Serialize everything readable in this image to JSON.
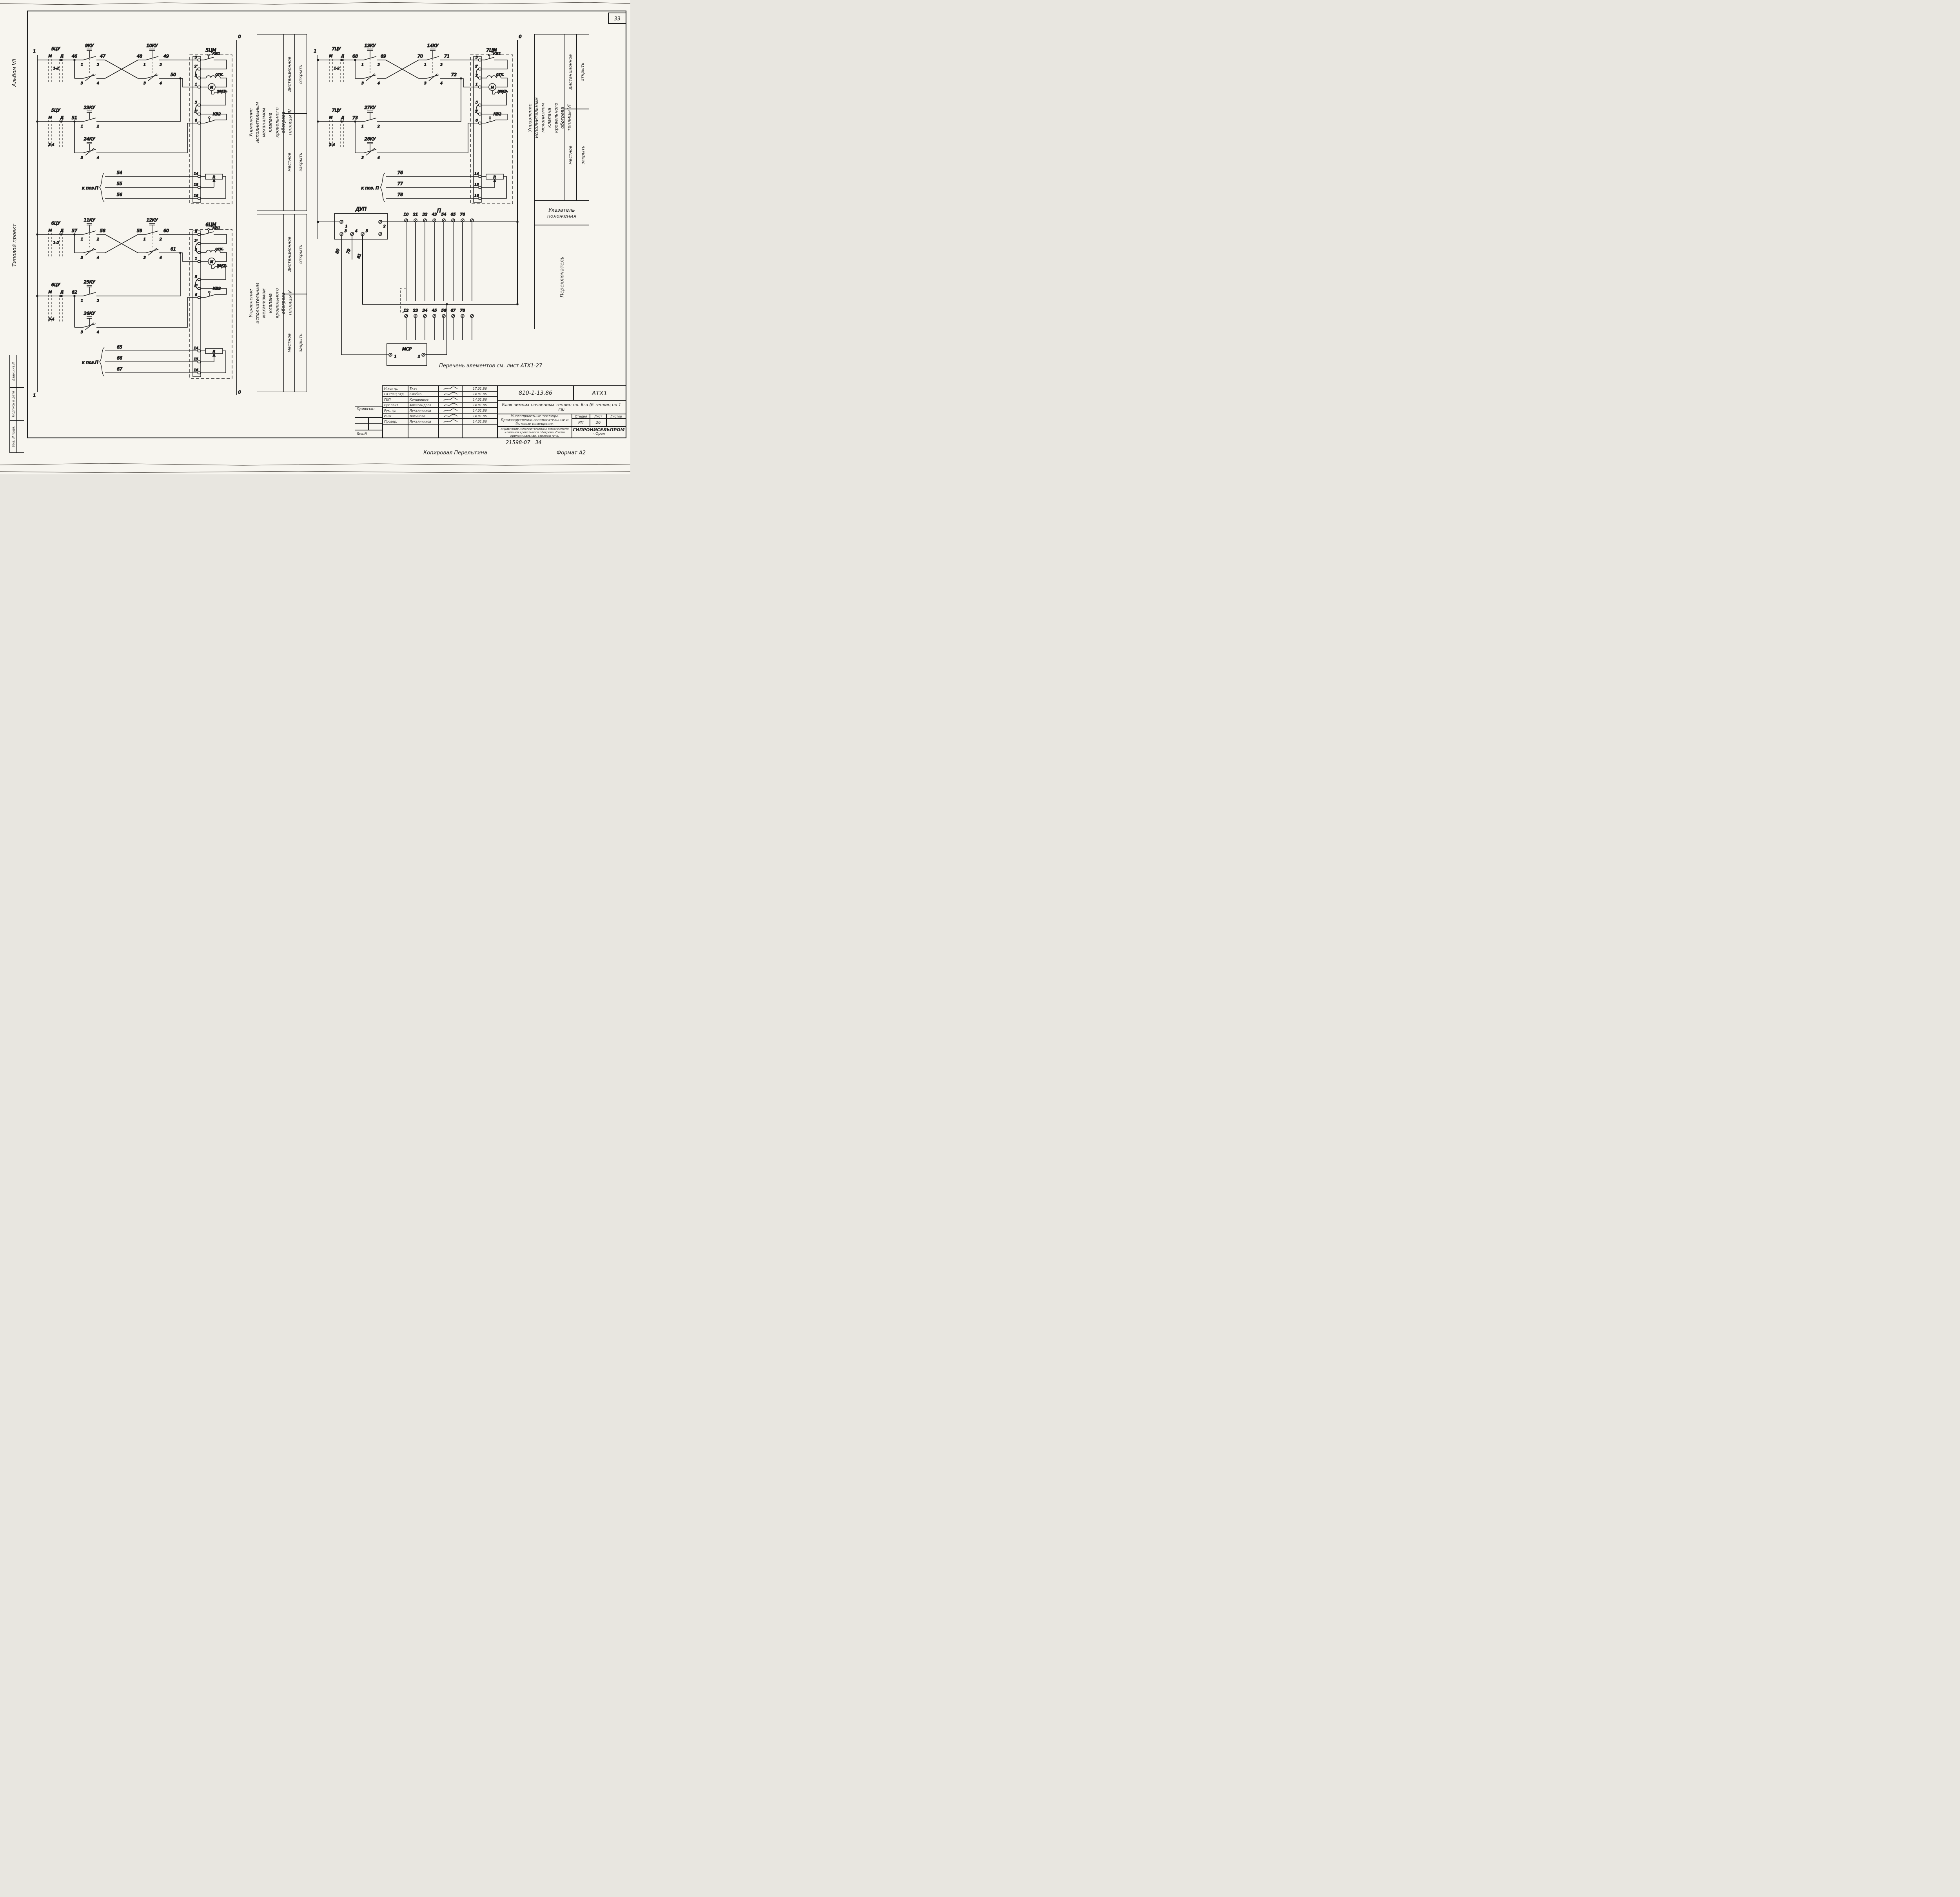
{
  "page": {
    "sheet_corner": "33",
    "footer_doc": "21598-07",
    "footer_sheet": "34",
    "copied": "Копировал Перелыгина",
    "format": "Формат А2"
  },
  "margin": {
    "album": "Альбом VII",
    "project_type": "Типовой проект",
    "stamp_top": "Взам.инв.N",
    "stamp_mid": "Подпись и дата",
    "stamp_bottom": "Инв. N подл."
  },
  "shared": {
    "m": "М",
    "d": "Д",
    "r12": "1-2",
    "r34": "3-4",
    "c1": "1",
    "c2": "2",
    "c3": "3",
    "c4": "4",
    "bus1": "1",
    "bus0": "0",
    "kv1": "КВ1",
    "kv2": "КВ2",
    "otk": "отк.",
    "zakr": "закр.",
    "motor": "М",
    "res": "R",
    "t3": "3",
    "t2p": "2'",
    "t2": "2",
    "t1": "1",
    "t5": "5",
    "t5p": "5'",
    "t6": "6",
    "t14": "14",
    "t15": "15",
    "t16": "16"
  },
  "c1": {
    "cu": "5ЦУ",
    "k1": "9КУ",
    "k2": "10КУ",
    "k3": "23КУ",
    "k4": "24КУ",
    "w1": "46",
    "w2": "47",
    "w3": "48",
    "w4": "49",
    "w5": "50",
    "w6": "51",
    "kpos": "к поз.П",
    "p1": "54",
    "p2": "55",
    "p3": "56",
    "cm": "5ЦМ"
  },
  "c2": {
    "cu": "6ЦУ",
    "k1": "11КУ",
    "k2": "12КУ",
    "k3": "25КУ",
    "k4": "26КУ",
    "w1": "57",
    "w2": "58",
    "w3": "59",
    "w4": "60",
    "w5": "61",
    "w6": "62",
    "kpos": "к поз.П",
    "p1": "65",
    "p2": "66",
    "p3": "67",
    "cm": "6ЦМ"
  },
  "c3": {
    "cu": "7ЦУ",
    "k1": "13КУ",
    "k2": "14КУ",
    "k3": "27КУ",
    "k4": "28КУ",
    "w1": "68",
    "w2": "69",
    "w3": "70",
    "w4": "71",
    "w5": "72",
    "w6": "73",
    "kpos": "к поз. П",
    "p1": "76",
    "p2": "77",
    "p3": "78",
    "cm": "7ЦМ"
  },
  "dup": {
    "title": "ДУП",
    "t1": "1",
    "t2": "2",
    "t3": "3",
    "t4": "4",
    "t5": "5",
    "w80": "80",
    "w79": "79",
    "w81": "81"
  },
  "pblock": {
    "title": "П",
    "top": [
      "10",
      "21",
      "32",
      "43",
      "54",
      "65",
      "76"
    ],
    "bottom": [
      "12",
      "23",
      "34",
      "45",
      "56",
      "67",
      "78"
    ]
  },
  "msr": {
    "title": "МСР",
    "t1": "1",
    "t2": "2"
  },
  "note": "Перечень  элементов  см.  лист  АТХ1-27",
  "tables": {
    "t1": "Управление исполнительным механизмом клапана кровельного обогрева теплицы IV",
    "t2": "Управление исполнительным механизмом кла­пана кровельного обогрева теплицы V",
    "t3": "Управление исполнительным механизмом кла­пана кровельного обогрева теплицы VI",
    "remote": "дистанционное",
    "open": "открыть",
    "local": "местное",
    "close": "закрыть",
    "pos1": "Указатель",
    "pos2": "положения",
    "switch": "Переключатель"
  },
  "tb": {
    "doc": "810-1-13.86",
    "code": "АТХ1",
    "object": "Блок зимних почвенных теплиц пл. 6га (6 теплиц по 1 га)",
    "project": "Многопролетные теплицы. Производственно-вспомогательные и бытовые помещения.",
    "content": "Управление исполнительными механизмами клапанов кровельного обогрева. Схема принципиальная. Теплицы IV-VI.",
    "stage_h": "Стадия",
    "sheet_h": "Лист",
    "sheets_h": "Листов",
    "stage": "РП",
    "sheet": "26",
    "sheets": "",
    "org": "ГИПРОНИСЕЛЬПРОМ",
    "city": "г.Орел",
    "attached": "Привязан",
    "inv": "Инв.N",
    "rows": [
      {
        "role": "Н.контр.",
        "name": "Ткач",
        "date": "17.01.86"
      },
      {
        "role": "Гл.спец.отд",
        "name": "Слабко",
        "date": "14.01.86"
      },
      {
        "role": "ГИП",
        "name": "Кондрашов",
        "date": "14.01.86"
      },
      {
        "role": "Рук.сект",
        "name": "Александров",
        "date": "14.01.86"
      },
      {
        "role": "Рук. гр.",
        "name": "Лукьянчиков",
        "date": "14.01.86"
      },
      {
        "role": "Инж.",
        "name": "Логинова",
        "date": "14.01.86"
      },
      {
        "role": "Провер.",
        "name": "Лукьянчиков",
        "date": "14.01.86"
      }
    ]
  }
}
